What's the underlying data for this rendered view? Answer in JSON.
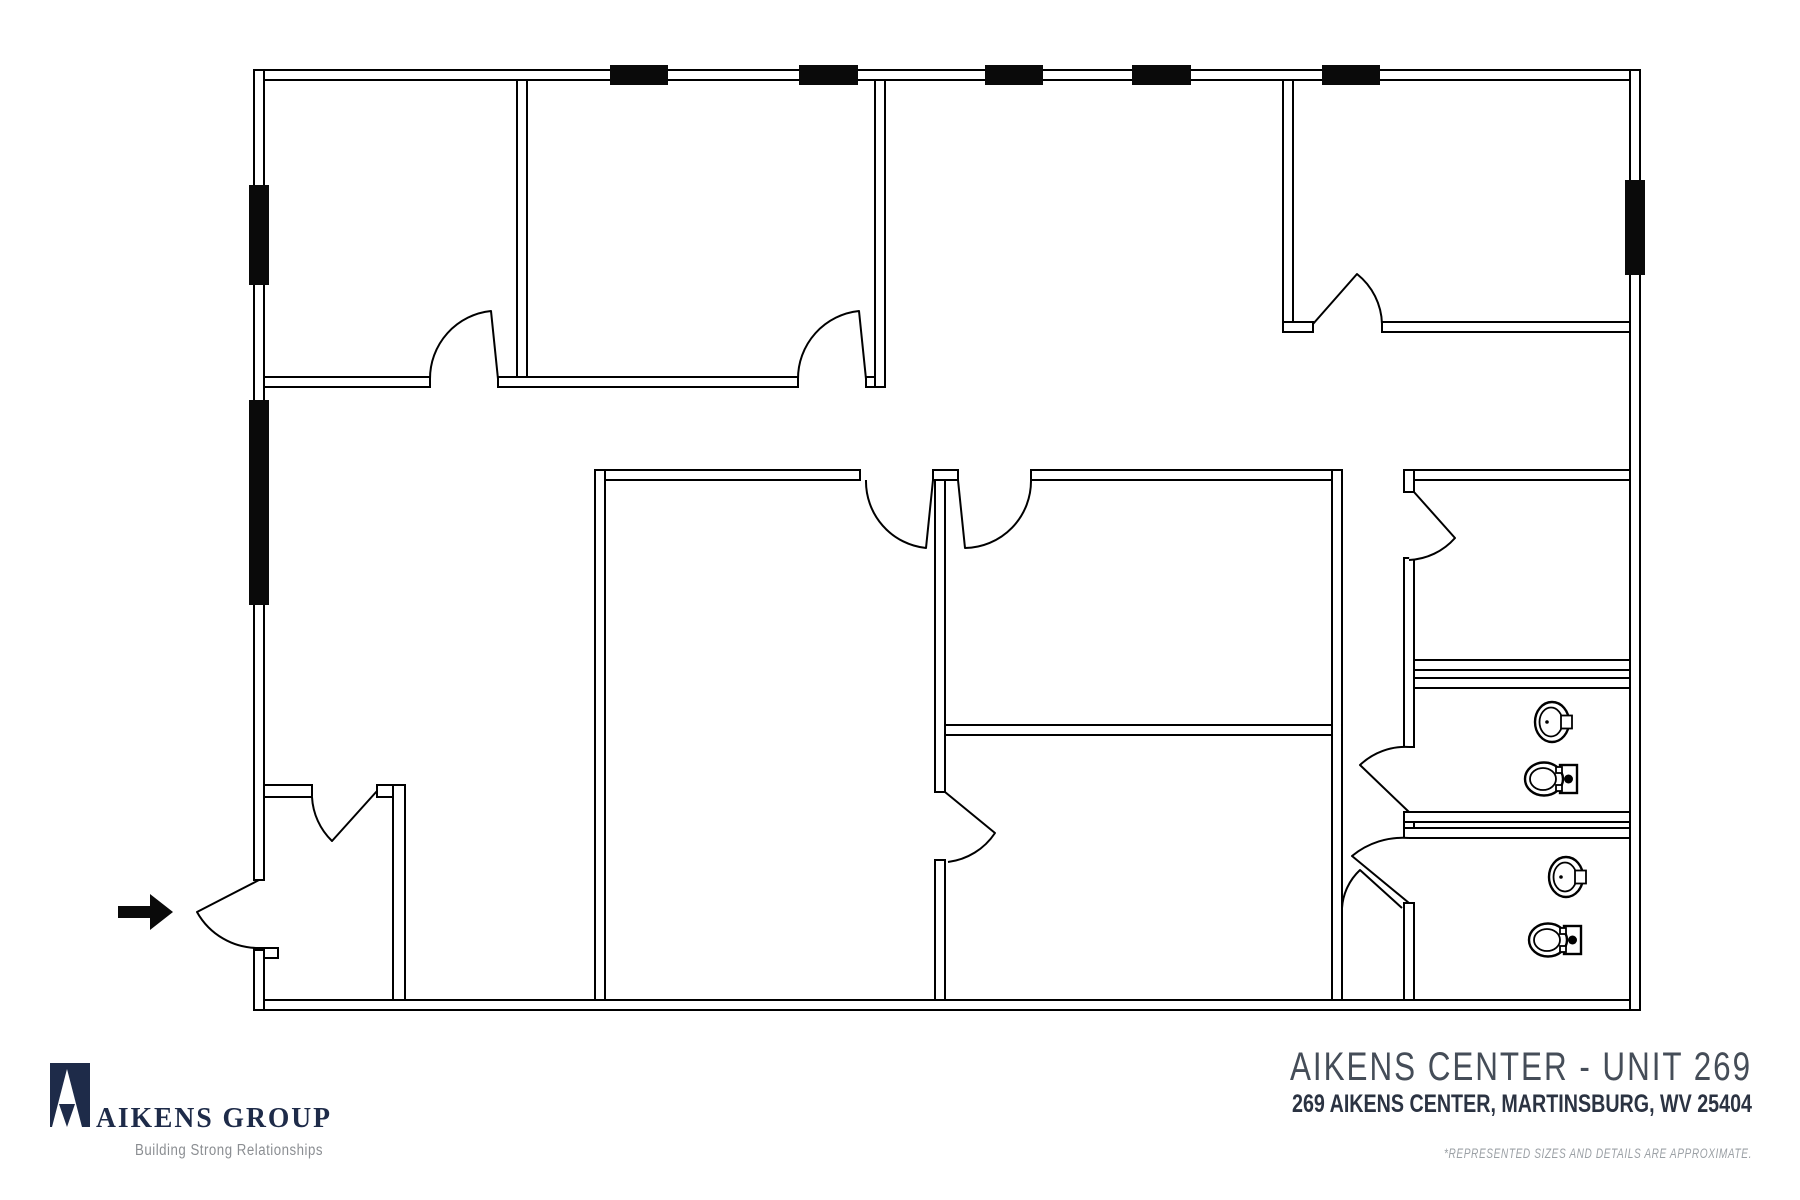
{
  "title_block": {
    "title": "AIKENS CENTER - UNIT 269",
    "address": "269 AIKENS CENTER, MARTINSBURG, WV 25404",
    "disclaimer": "*REPRESENTED SIZES AND DETAILS ARE APPROXIMATE."
  },
  "logo": {
    "name": "AIKENS GROUP",
    "tagline": "Building Strong Relationships"
  },
  "floor_plan": {
    "type": "architectural line drawing, black on white",
    "window_marker_count": 8,
    "door_swing_count": 12,
    "entry_arrow_icon": "black right-pointing arrow at exterior entry door, lower-left",
    "fixtures": {
      "restroom_upper": [
        "sink",
        "toilet"
      ],
      "restroom_lower": [
        "sink",
        "toilet"
      ]
    }
  },
  "colors": {
    "line_black": "#000000",
    "brand_navy": "#1e2b49",
    "title_gray": "#454d58",
    "address_navy": "#2b3342",
    "disclaimer_gray": "#9ba0a5",
    "tagline_gray": "#8b8e92",
    "background": "#ffffff"
  }
}
